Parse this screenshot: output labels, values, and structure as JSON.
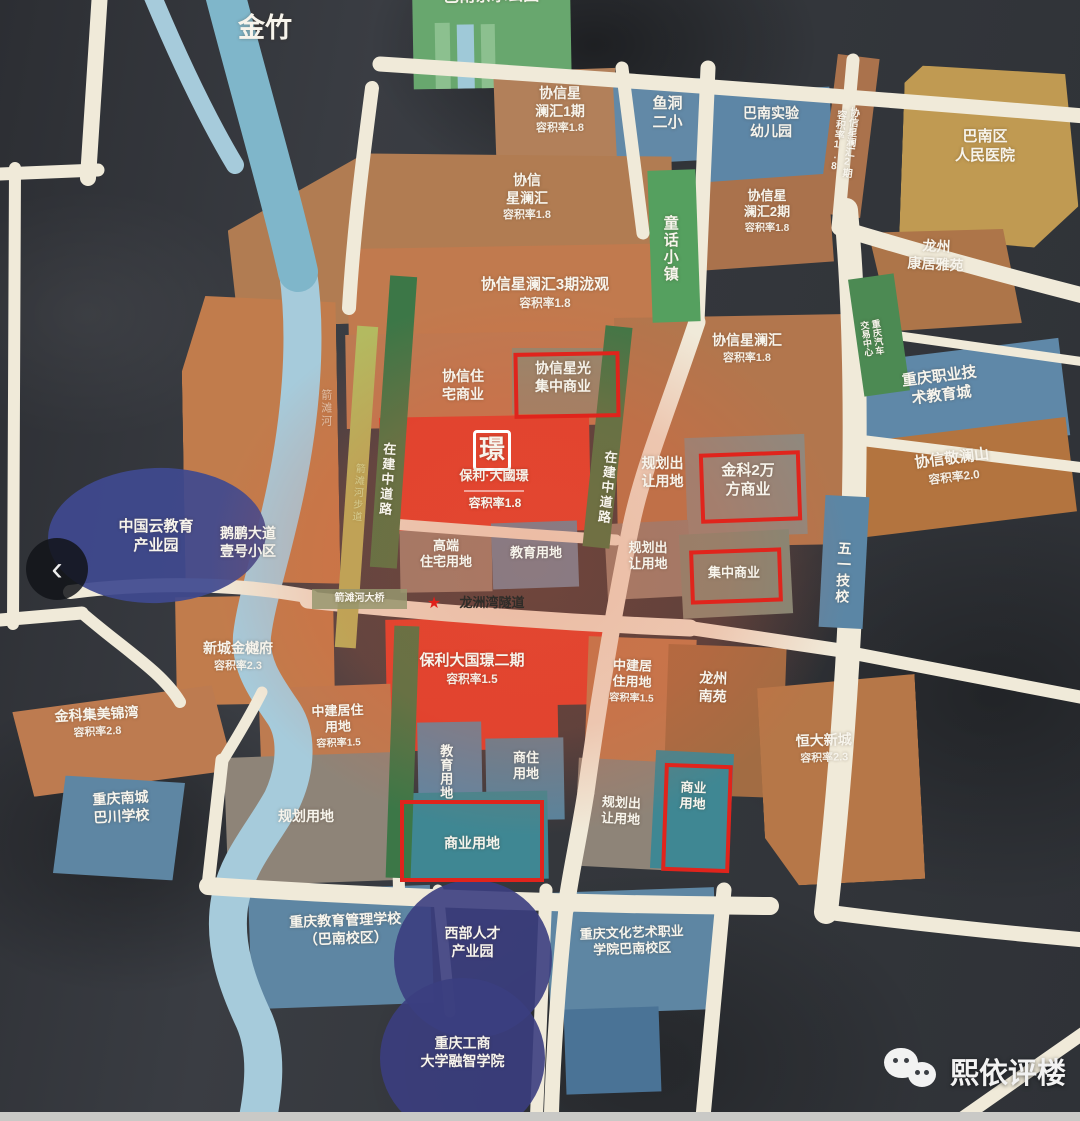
{
  "ui": {
    "back_icon": "‹",
    "star": "★",
    "watermark": "熙依评楼",
    "watermark_icon": "wechat-icon"
  },
  "colors": {
    "highlight_box": "#e0241c",
    "road": "#f0ead9",
    "river": "#a6cbdb",
    "poly_red": "#e23a2b",
    "residential_brown": "#b17c52",
    "commercial_teal": "#3f8793",
    "school_blue": "#5e86a3",
    "planning_gray": "#8e8478",
    "road_under_construction_green": "#3c7747",
    "campus_navy": "#3b3e80",
    "hospital_gold": "#c09a52",
    "overlay_wash": "rgba(228,96,58,0.3)"
  },
  "labels": {
    "jinzhu": "金竹",
    "park": "巴南亲水公园",
    "xx1": {
      "n": "协信星\n澜汇1期",
      "f": "容积率1.8"
    },
    "yudong": "鱼洞\n二小",
    "shiyan": "巴南实验\n幼儿园",
    "hospital": "巴南区\n人民医院",
    "xxmain": {
      "n": "协信\n星澜汇",
      "f": "容积率1.8"
    },
    "tonghua": "童话小镇",
    "xx2": {
      "n": "协信星\n澜汇2期",
      "f": "容积率1.8"
    },
    "xx2v": "协信星澜汇2期\n容积率1.8",
    "kangju": "龙州\n康居雅苑",
    "xx3": {
      "n": "协信星澜汇3期泷观",
      "f": "容积率1.8"
    },
    "qimao": "重庆汽车\n交易中心",
    "zhijiao": "重庆职业技\n术教育城",
    "xxright": {
      "n": "协信星澜汇",
      "f": "容积率1.8"
    },
    "zhuzhai": "协信住\n宅商业",
    "xingguang": "协信星光\n集中商业",
    "zaijian": "在建中道路",
    "river": "箭滩河",
    "riverwalk": "箭滩河步道",
    "poly1": {
      "logo": "璟",
      "brand": "保利·大國璟",
      "f": "容积率1.8"
    },
    "ghcr": "规划出\n让用地",
    "jinke2w": "金科2万\n方商业",
    "jinglan": {
      "n": "协信敬澜山",
      "f": "容积率2.0"
    },
    "wuyi": "五一技校",
    "cloud": "中国云教育\n产业园",
    "hepeng": "鹅鹏大道\n壹号小区",
    "gaoduan": "高端\n住宅用地",
    "jiaoyu": "教育用地",
    "jizhong": "集中商业",
    "tunnel": "龙洲湾隧道",
    "bridge": "箭滩河大桥",
    "xincheng": {
      "n": "新城金樾府",
      "f": "容积率2.3"
    },
    "poly2": {
      "n": "保利大国璟二期",
      "f": "容积率1.5"
    },
    "zhongjian_r": {
      "n": "中建居\n住用地",
      "f": "容积率1.5"
    },
    "zhongjian_l": {
      "n": "中建居住\n用地",
      "f": "容积率1.5"
    },
    "longzhouny": "龙州\n南苑",
    "jimei": {
      "n": "金科集美锦湾",
      "f": "容积率2.8"
    },
    "shangzhu": "商住\n用地",
    "bachuan": "重庆南城\n巴川学校",
    "ghyd": "规划用地",
    "shangye_h": "商业用地",
    "shangye_v": "商业\n用地",
    "hengda": {
      "n": "恒大新城",
      "f": "容积率2.3"
    },
    "jyglxx": "重庆教育管理学校\n（巴南校区）",
    "xibu": "西部人才\n产业园",
    "whys": "重庆文化艺术职业\n学院巴南校区",
    "gsdx": "重庆工商\n大学融智学院"
  }
}
